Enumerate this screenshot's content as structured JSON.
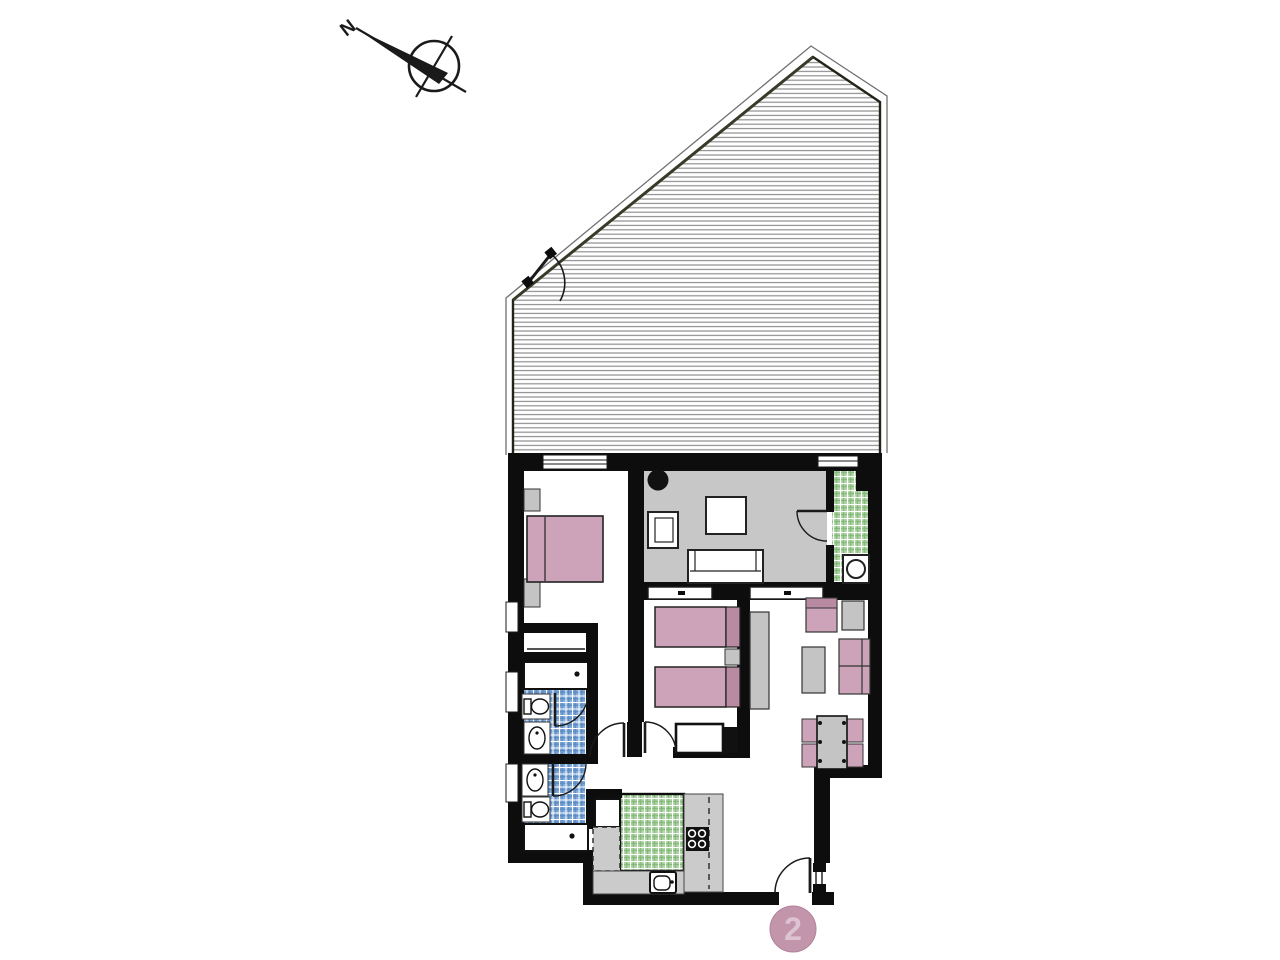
{
  "plan": {
    "compass_label": "N",
    "unit_badge": "2"
  },
  "rooms": [
    {
      "id": "terrace",
      "floor": "hatched-deck"
    },
    {
      "id": "bedroom-1",
      "floor": "white"
    },
    {
      "id": "living-room",
      "floor": "gray"
    },
    {
      "id": "utility-room",
      "floor": "green-tile"
    },
    {
      "id": "bedroom-2",
      "floor": "white"
    },
    {
      "id": "dining-area",
      "floor": "white"
    },
    {
      "id": "bathroom-1",
      "floor": "blue-tile"
    },
    {
      "id": "bathroom-2",
      "floor": "blue-tile"
    },
    {
      "id": "kitchen",
      "floor": "green-tile"
    },
    {
      "id": "entry-hall",
      "floor": "white"
    }
  ],
  "colors": {
    "wall": "#0d0d0d",
    "line": "#1a1a1a",
    "floor_living": "#c7c7c7",
    "counter": "#cbcbcb",
    "furniture_gray": "#c4c4c4",
    "pink": "#cda3b9",
    "pink_dark": "#b98ba3",
    "badge_bg": "#c295ab",
    "badge_text": "#ddc3d2",
    "tile_blue": "#85abd9",
    "tile_blue_line": "#5d8cc4",
    "tile_green": "#b2d5a8",
    "tile_green_line": "#86ba7d",
    "hatch_line": "#8f8f8f",
    "outline": "#707070"
  }
}
